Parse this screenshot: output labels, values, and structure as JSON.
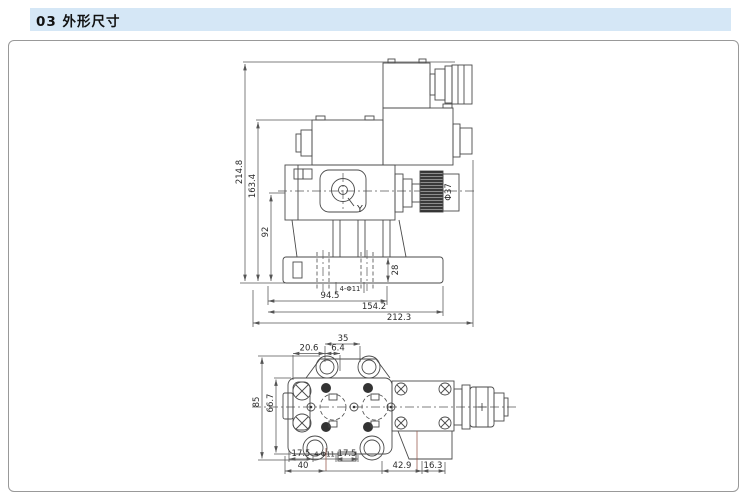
{
  "header": {
    "title": "03 外形尺寸"
  },
  "drawing": {
    "side_view": {
      "overall_height": "214.8",
      "mid_height": "163.4",
      "center_height": "92",
      "knob_diameter": "Φ37",
      "port_label": "Y",
      "base_height": "28",
      "mounting_holes": "4-Φ11",
      "hole_span": "94.5",
      "body_length": "154.2",
      "overall_length": "212.3"
    },
    "bottom_view": {
      "top_width": "35",
      "top_offset_left": "20.6",
      "top_offset_mid": "6.4",
      "flange_height": "85",
      "bolt_spacing": "66.7",
      "bottom_left_offset": "17.5",
      "bottom_holes": "4-Φ11",
      "bottom_mid_offset": "17.5",
      "base_width": "40",
      "solenoid_offset": "42.9",
      "connector_offset": "16.3"
    }
  }
}
